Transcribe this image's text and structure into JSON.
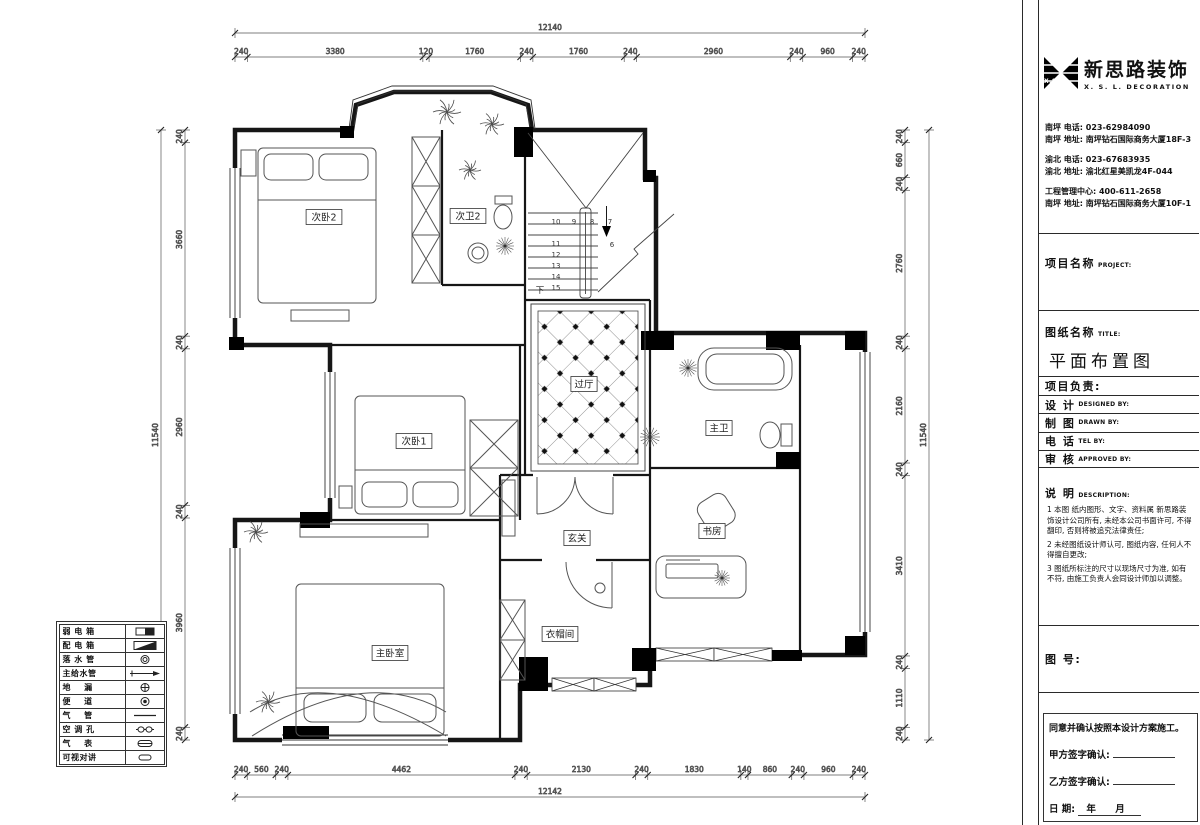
{
  "logo": {
    "abbr": "X.S.L",
    "brand_cn": "新思路装饰",
    "brand_en": "X. S. L. DECORATION"
  },
  "contact": {
    "lines": [
      "南坪  电话: 023-62984090",
      "南坪  地址: 南坪钻石国际商务大厦18F-3",
      "渝北  电话: 023-67683935",
      "渝北  地址: 渝北红星美凯龙4F-044",
      "工程管理中心: 400-611-2658",
      "南坪  地址: 南坪钻石国际商务大厦10F-1"
    ]
  },
  "title_block": {
    "project_label": "项目名称",
    "project_label_en": "PROJECT:",
    "drawing_label": "图纸名称",
    "drawing_label_en": "TITLE:",
    "drawing_title": "平面布置图",
    "rows": [
      {
        "cn": "项目负责:",
        "en": ""
      },
      {
        "cn": "设  计",
        "en": "DESIGNED BY:"
      },
      {
        "cn": "制  图",
        "en": "DRAWN BY:"
      },
      {
        "cn": "电  话",
        "en": "TEL BY:"
      },
      {
        "cn": "审  核",
        "en": "APPROVED BY:"
      }
    ],
    "description_label": "说  明",
    "description_label_en": "DESCRIPTION:",
    "notes": [
      "1 本图 纸内图形、文字、资料属 新思路装饰设计公司所有, 未经本公司书面许可, 不得翻印, 否则将被追究法律责任;",
      "2 未经图纸设计师认可, 图纸内容, 任何人不得擅自更改;",
      "3 图纸所标注的尺寸以现场尺寸为准, 如有不符, 由施工负责人会同设计师加以调整。"
    ],
    "figure_no_label": "图 号:",
    "signature": {
      "statement": "同意并确认按照本设计方案施工。",
      "party_a": "甲方签字确认:",
      "party_b": "乙方签字确认:",
      "date_label": "日        期:",
      "date_value": "年  月"
    }
  },
  "legend": {
    "items": [
      {
        "label": "弱 电 箱",
        "symbol": "weak-current-box"
      },
      {
        "label": "配 电 箱",
        "symbol": "distribution-box"
      },
      {
        "label": "落 水 管",
        "symbol": "downpipe"
      },
      {
        "label": "主给水管",
        "symbol": "water-main"
      },
      {
        "label": "地    漏",
        "symbol": "floor-drain"
      },
      {
        "label": "便    道",
        "symbol": "toilet"
      },
      {
        "label": "气    管",
        "symbol": "gas-pipe"
      },
      {
        "label": "空 调 孔",
        "symbol": "ac-hole"
      },
      {
        "label": "气    表",
        "symbol": "gas-meter"
      },
      {
        "label": "可视对讲",
        "symbol": "video-intercom"
      }
    ]
  },
  "plan": {
    "rooms": [
      {
        "name": "次卧2",
        "x": 324,
        "y": 217
      },
      {
        "name": "次卫2",
        "x": 468,
        "y": 216
      },
      {
        "name": "过厅",
        "x": 584,
        "y": 384
      },
      {
        "name": "次卧1",
        "x": 414,
        "y": 441
      },
      {
        "name": "主卫",
        "x": 719,
        "y": 428
      },
      {
        "name": "玄关",
        "x": 577,
        "y": 538
      },
      {
        "name": "书房",
        "x": 712,
        "y": 531
      },
      {
        "name": "主卧室",
        "x": 390,
        "y": 653
      },
      {
        "name": "衣帽间",
        "x": 560,
        "y": 634
      }
    ],
    "stairs": {
      "top_row": [
        "10",
        "9",
        "8",
        "7"
      ],
      "right_number": "6",
      "left_col": [
        "11",
        "12",
        "13",
        "14",
        "15"
      ],
      "down_label": "下"
    },
    "dimensions": {
      "top": {
        "total": "12140",
        "segments": [
          "240",
          "3380",
          "120",
          "1760",
          "240",
          "1760",
          "240",
          "2960",
          "240",
          "960",
          "240"
        ]
      },
      "bottom": {
        "total": "12142",
        "segments": [
          "240",
          "560",
          "240",
          "4462",
          "240",
          "2130",
          "240",
          "1830",
          "140",
          "860",
          "240",
          "960",
          "240"
        ]
      },
      "left": {
        "total": "11540",
        "segments": [
          "240",
          "3660",
          "240",
          "2960",
          "240",
          "3960",
          "240"
        ]
      },
      "right": {
        "total": "11540",
        "segments": [
          "240",
          "660",
          "240",
          "2760",
          "240",
          "2160",
          "240",
          "3410",
          "240",
          "1110",
          "240"
        ]
      }
    }
  }
}
